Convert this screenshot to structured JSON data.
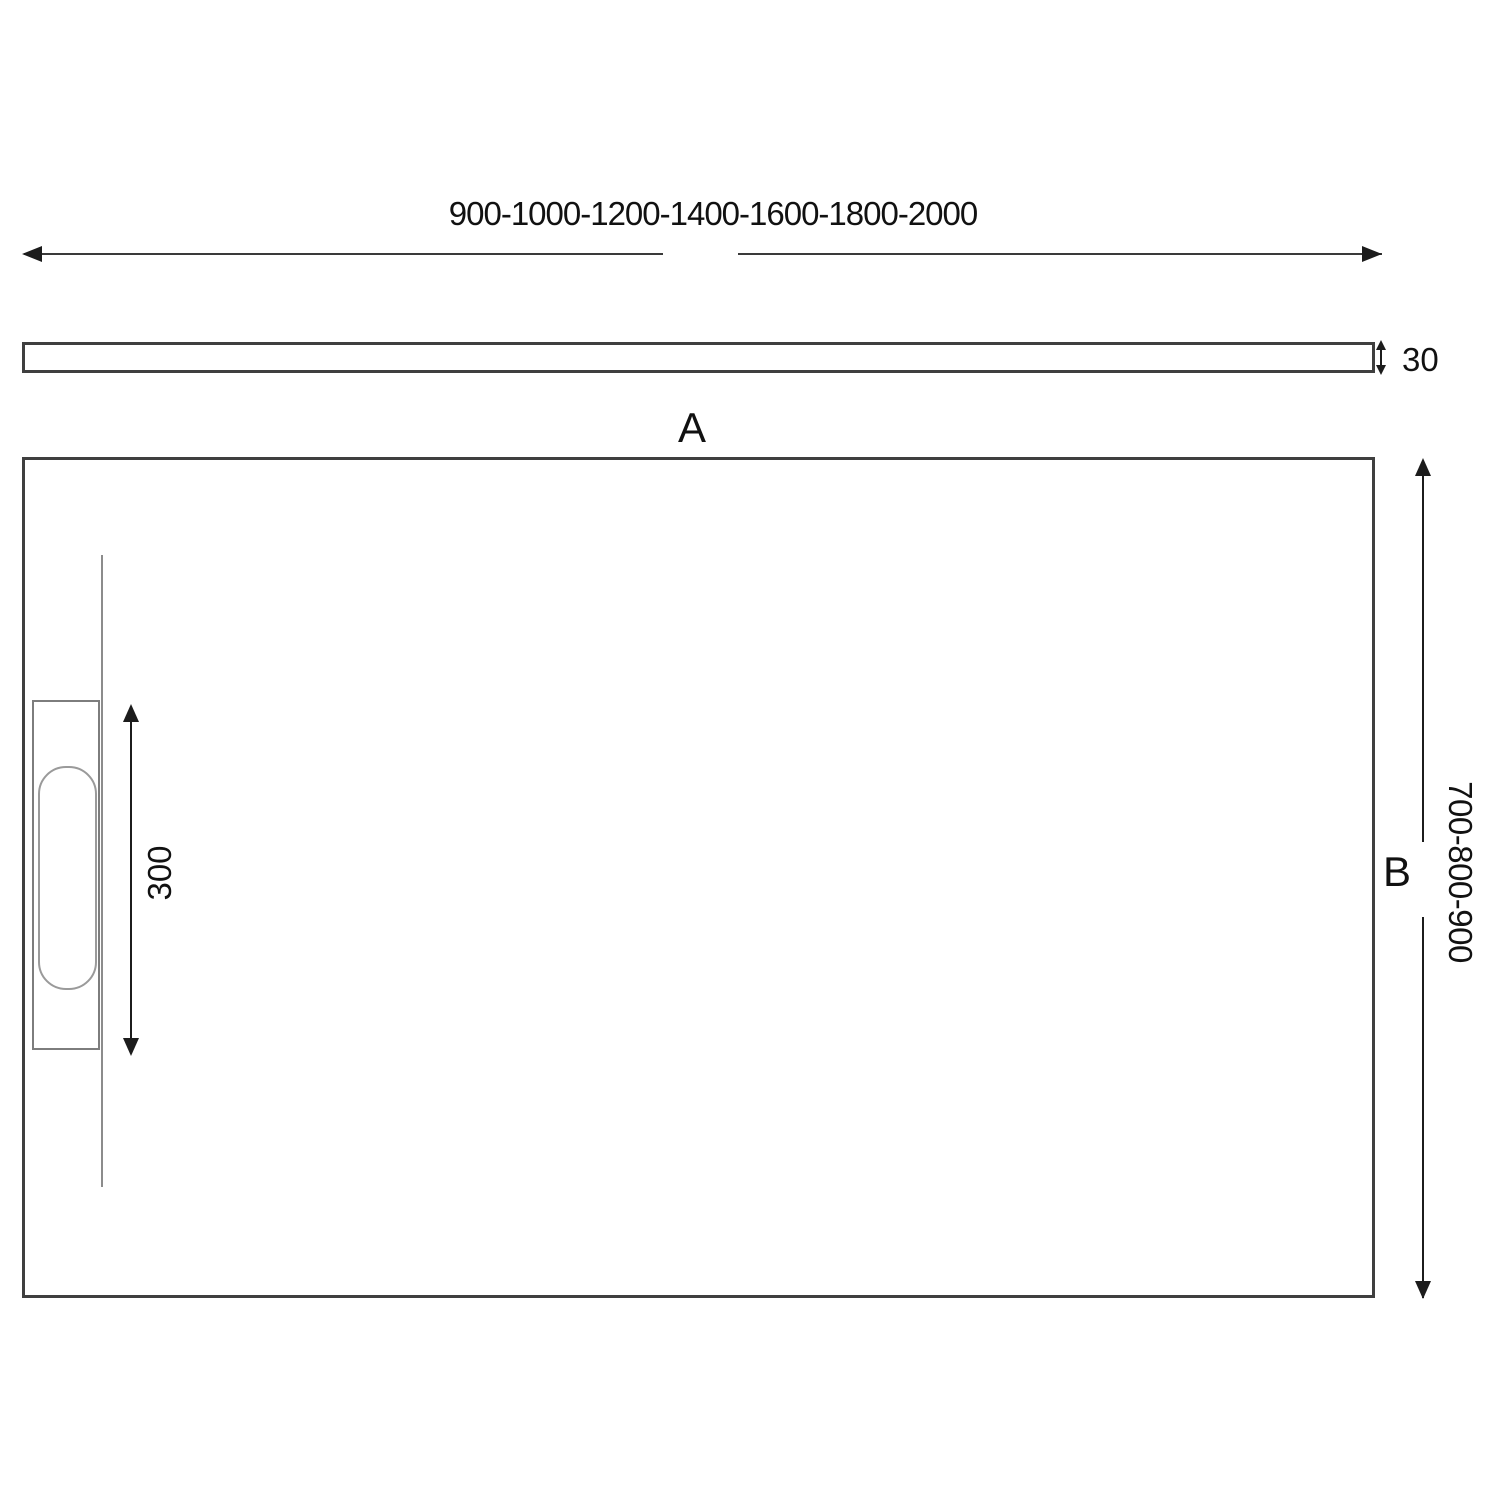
{
  "diagram": {
    "length_options": "900-1000-1200-1400-1600-1800-2000",
    "thickness": "30",
    "label_a": "A",
    "label_b": "B",
    "drain_length": "300",
    "width_options": "700-800-900"
  },
  "colors": {
    "background": "#ffffff",
    "tray_outline": "#3f3f3f",
    "drain_outline": "#8c8c8c",
    "dimension_ink": "#1c1c1c"
  }
}
